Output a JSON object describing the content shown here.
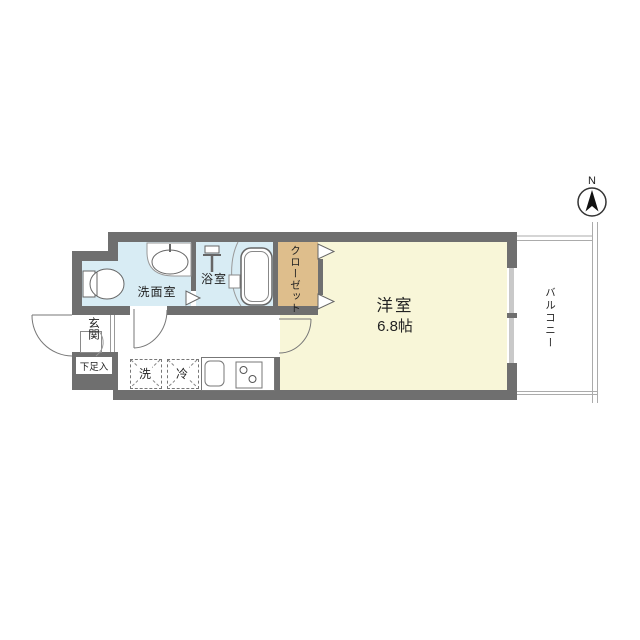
{
  "compass": {
    "north_label": "N"
  },
  "rooms": {
    "main_room": {
      "label": "洋室",
      "area": "6.8帖"
    },
    "balcony": {
      "label": "バルコニー"
    },
    "closet": {
      "label": "クローゼット"
    },
    "bathroom": {
      "label": "浴室"
    },
    "washroom": {
      "label": "洗面室"
    },
    "entrance": {
      "label": "玄関"
    },
    "shoe_storage": {
      "label": "下足入"
    },
    "washer": {
      "label": "洗"
    },
    "fridge": {
      "label": "冷"
    }
  },
  "colors": {
    "wall": "#6f6f6f",
    "wet": "#d8ecf4",
    "closet": "#debe8c",
    "room": "#f8f6d8",
    "line": "#999999"
  }
}
